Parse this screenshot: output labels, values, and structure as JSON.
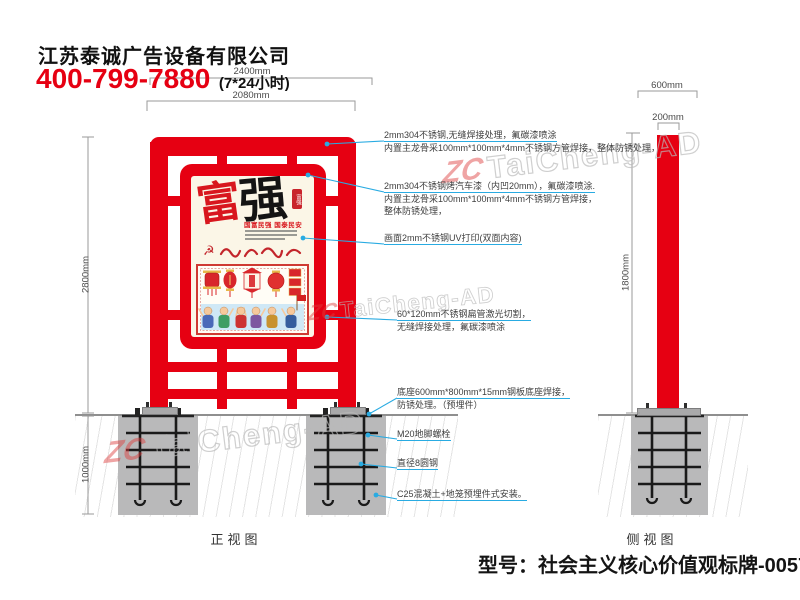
{
  "header": {
    "company": "江苏泰诚广告设备有限公司",
    "phone": "400-799-7880",
    "hours": "(7*24小时)"
  },
  "dimensions": {
    "overall_width": "2400mm",
    "frame_width": "2080mm",
    "front_height": "2800mm",
    "foundation_depth": "1000mm",
    "side_base_width": "600mm",
    "side_pole_width": "200mm",
    "side_pole_height": "1800mm"
  },
  "annotations": [
    {
      "lines": [
        "2mm304不锈钢,无缝焊接处理，氟碳漆喷涂",
        "内置主龙骨采100mm*100mm*4mm不锈钢方管焊接，整体防锈处理，"
      ]
    },
    {
      "lines": [
        "2mm304不锈钢烤汽车漆（内凹20mm），氟碳漆喷涂.",
        "内置主龙骨采100mm*100mm*4mm不锈钢方管焊接，",
        "整体防锈处理，"
      ]
    },
    {
      "lines": [
        "画面2mm不锈钢UV打印(双面内容)"
      ]
    },
    {
      "lines": [
        "60*120mm不锈钢扁管激光切割，",
        "无缝焊接处理，氟碳漆喷涂"
      ]
    },
    {
      "lines": [
        "底座600mm*800mm*15mm钢板底座焊接，",
        "防锈处理。（预埋件）"
      ]
    },
    {
      "lines": [
        "M20地脚螺栓"
      ]
    },
    {
      "lines": [
        "直径8圆钢"
      ]
    },
    {
      "lines": [
        "C25混凝土+地笼预埋件式安装。"
      ]
    }
  ],
  "poster": {
    "char_left": "富",
    "char_right": "强",
    "subtitle": "国富民强 国泰民安",
    "seal_text": "富强"
  },
  "views": {
    "front_label": "正视图",
    "side_label": "侧视图"
  },
  "footer": {
    "model": "型号：社会主义核心价值观标牌-0057"
  },
  "watermark": {
    "logo": "ZC",
    "text": "TaiCheng-AD"
  },
  "colors": {
    "red": "#e60012",
    "leader": "#29abe2",
    "concrete": "#b9b9ba",
    "dim": "#9a9a9a",
    "poster_bg": "#fbf6e7"
  }
}
